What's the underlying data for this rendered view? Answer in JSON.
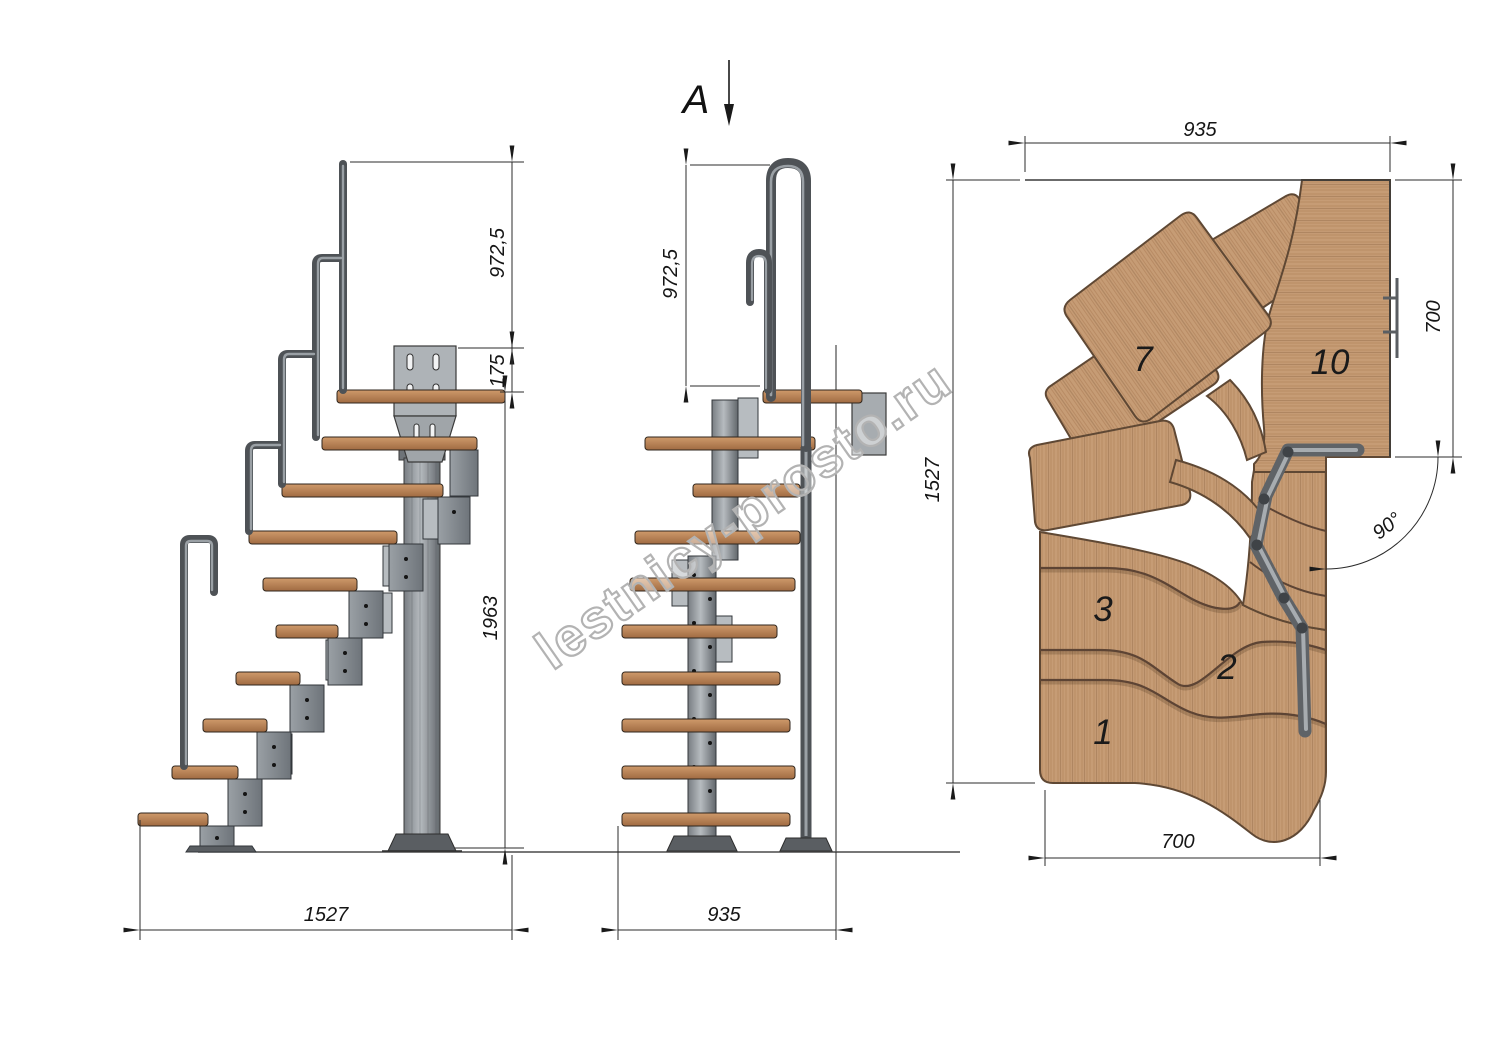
{
  "colors": {
    "wood": "#c49a73",
    "wood_side": "#b5784e",
    "wood_edge": "#5f4834",
    "metal": "#8e9398",
    "metal_dark": "#4e5256",
    "plate_light": "#b7bcc0",
    "line": "#2b2b2b",
    "watermark_gray": "#b3b3b3"
  },
  "watermark": {
    "text": "lestnicy-prosto.ru"
  },
  "front_view": {
    "section_label": "A",
    "dim_height_rail": "972,5",
    "dim_width": "935"
  },
  "side_view": {
    "dim_height_rail": "972,5",
    "dim_platform_offset": "175",
    "dim_height_column": "1963",
    "dim_length": "1527"
  },
  "plan_view": {
    "dim_width_top": "935",
    "dim_length_left": "1527",
    "dim_depth_right": "700",
    "dim_width_bottom": "700",
    "dim_turn_angle": "90°",
    "step_labels": {
      "step1": "1",
      "step2": "2",
      "step3": "3",
      "step7": "7",
      "step10": "10"
    }
  }
}
